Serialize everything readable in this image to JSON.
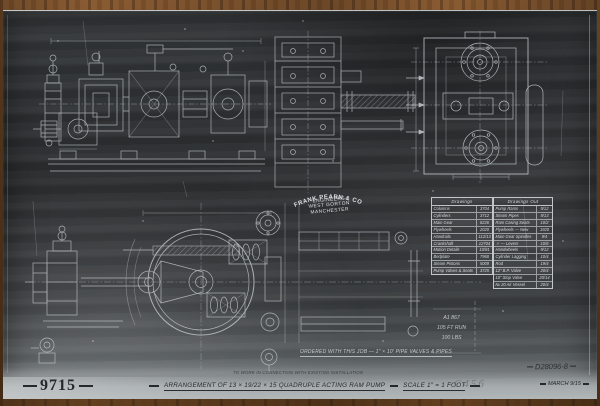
{
  "photo": {
    "drawing_number": "9715",
    "title": "Arrangement of 13 × 19/22 × 15 Quadruple Acting Ram Pump",
    "scale_label": "Scale 1″ = 1 Foot",
    "date": "March 9/15",
    "negative_number": "D28096-8",
    "pencil_mark": "C456",
    "connection_note": "To work in connection with existing installation"
  },
  "stamp": {
    "company": "Frank Pearn & Co Ld",
    "line2": "Engineers",
    "line3": "West Gorton",
    "line4": "Manchester"
  },
  "notes": {
    "ordered_note": "Ordered with this job — 1″ × 10′ Pipe Valves & Pipes",
    "duty_line1": "A1 867",
    "duty_line2": "105 Ft Run",
    "duty_line3": "100 Lbs"
  },
  "tables": {
    "drawings": {
      "header": "Drawings",
      "rows": [
        [
          "Columns",
          "3704"
        ],
        [
          "Cylinders",
          "3712"
        ],
        [
          "Main Gear",
          "8226"
        ],
        [
          "Flywheels",
          "2020"
        ],
        [
          "Handrails",
          "112/13"
        ],
        [
          "Crankshaft",
          "12704"
        ],
        [
          "Motion Details",
          "10/81"
        ],
        [
          "Bedplate",
          "7968"
        ],
        [
          "Steam Pistons",
          "5009"
        ],
        [
          "Pump Valves & Seats",
          "3725"
        ]
      ]
    },
    "drawings_out": {
      "header": "Drawings Out",
      "rows": [
        [
          "Pump Rams",
          "9/12"
        ],
        [
          "Steam Pipes",
          "9/13"
        ],
        [
          "Ram Casing Seats",
          "10/2"
        ],
        [
          "Flywheels — New",
          "1920"
        ],
        [
          "Main Gear Spindles",
          "9/4"
        ],
        [
          "〃 — Levers",
          "10/6"
        ],
        [
          "Handwheels",
          "9/12"
        ],
        [
          "Cylinder Lagging",
          "10/4"
        ],
        [
          "Rod",
          "19/4"
        ],
        [
          "12″ B.P. Valve",
          "20/4"
        ],
        [
          "10″ Stop Valve",
          "20/14"
        ],
        [
          "№ 20 Air Vessel",
          "20/4"
        ]
      ]
    }
  },
  "colors": {
    "line_white": "#ccd1d3",
    "photo_dark": "#2b2d2f",
    "band_light": "#b2b7b9",
    "wood": "#7a4f2b",
    "ink_dark": "#26292b"
  }
}
